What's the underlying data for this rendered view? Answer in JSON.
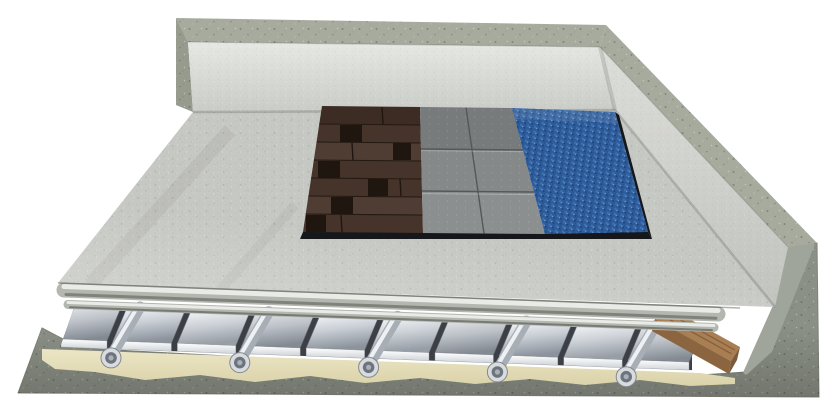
{
  "illustration": {
    "subject": "underfloor-heating-floor-construction-cutaway",
    "background_color": "#ffffff",
    "colors": {
      "concrete_top": "#a6ab9d",
      "concrete_mass": "#8b9086",
      "concrete_cut": "#a0a59b",
      "wall_inner_light": "#e6e8e4",
      "wall_inner_dark": "#c9ccc7",
      "floor_screed": "#c6c8c3",
      "roll_base": "#b3b7af",
      "roll_highlight": "#e9ebe7",
      "roll_shadow": "#7f837b",
      "plate_track_dark": "#3c4046",
      "plate_light": "#f1f3f5",
      "plate_mid": "#c9ced5",
      "plate_dark": "#8c939c",
      "plate_lip_light": "#ffffff",
      "plate_lip_dark": "#cfd4d8",
      "pipe_body": "#a8aeb6",
      "pipe_highlight": "#eef1f3",
      "pipe_face": "#d8dcdf",
      "pipe_bore": "#6d747d",
      "pipe_core": "#a9b0b7",
      "adhesive": "#ece6c6",
      "batten_top": "#a87e52",
      "batten_side": "#8a6540",
      "batten_end": "#7c5a3a",
      "wood_floor": "#46332a",
      "wood_joint": "#241a12",
      "tile": "#85898a",
      "tile_joint": "#55585a",
      "carpet": "#2e5c9b",
      "sample_edge": "#15171a"
    },
    "construction_layers": [
      {
        "name": "concrete subfloor slab"
      },
      {
        "name": "levelling adhesive layer"
      },
      {
        "name": "aluminium heat diffusion plates"
      },
      {
        "name": "heating pipes"
      },
      {
        "name": "timber edge batten"
      },
      {
        "name": "screed load-distribution boards"
      },
      {
        "name": "floor covering samples"
      },
      {
        "name": "perimeter walls with interior lining"
      }
    ],
    "floor_coverings": [
      {
        "name": "dark wood plank flooring"
      },
      {
        "name": "grey ceramic tiles"
      },
      {
        "name": "blue carpet"
      }
    ],
    "counts": {
      "heat_plates": 10,
      "visible_pipe_ends": 5,
      "tile_rows": 3,
      "tile_columns": 2,
      "covering_samples": 3
    }
  }
}
